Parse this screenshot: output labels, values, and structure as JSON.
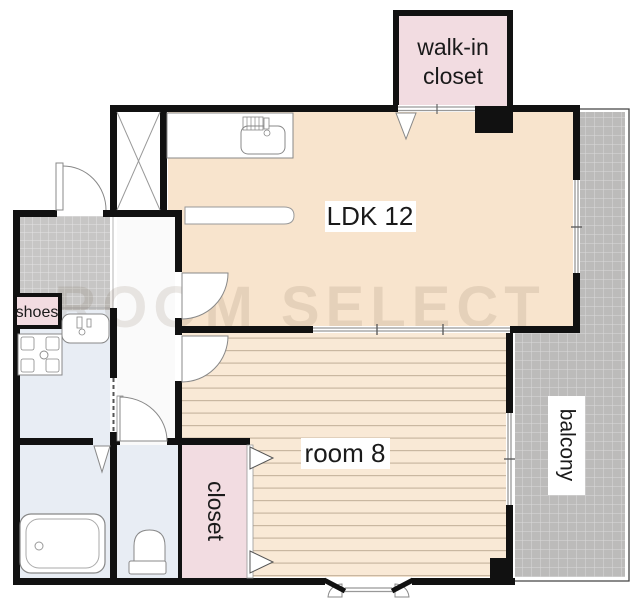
{
  "watermark": {
    "text": "ROOM SELECT"
  },
  "rooms": {
    "ldk": {
      "label": "LDK 12"
    },
    "room8": {
      "label": "room 8"
    },
    "balcony": {
      "label": "balcony"
    },
    "closet": {
      "label": "closet"
    },
    "walk_in_closet": {
      "line1": "walk-in",
      "line2": "closet"
    },
    "shoes": {
      "label": "shoes"
    }
  },
  "colors": {
    "ldk_floor": "#f8e4cd",
    "plank_floor": "#f9e9d6",
    "plank_line": "#c9b7a1",
    "closet_pink": "#f2dce1",
    "balcony_gray": "#bcbbba",
    "tile_gray": "#c7c6c5",
    "wet_floor": "#e8edf4",
    "hall_floor": "#fafafa",
    "wall": "#111111"
  }
}
